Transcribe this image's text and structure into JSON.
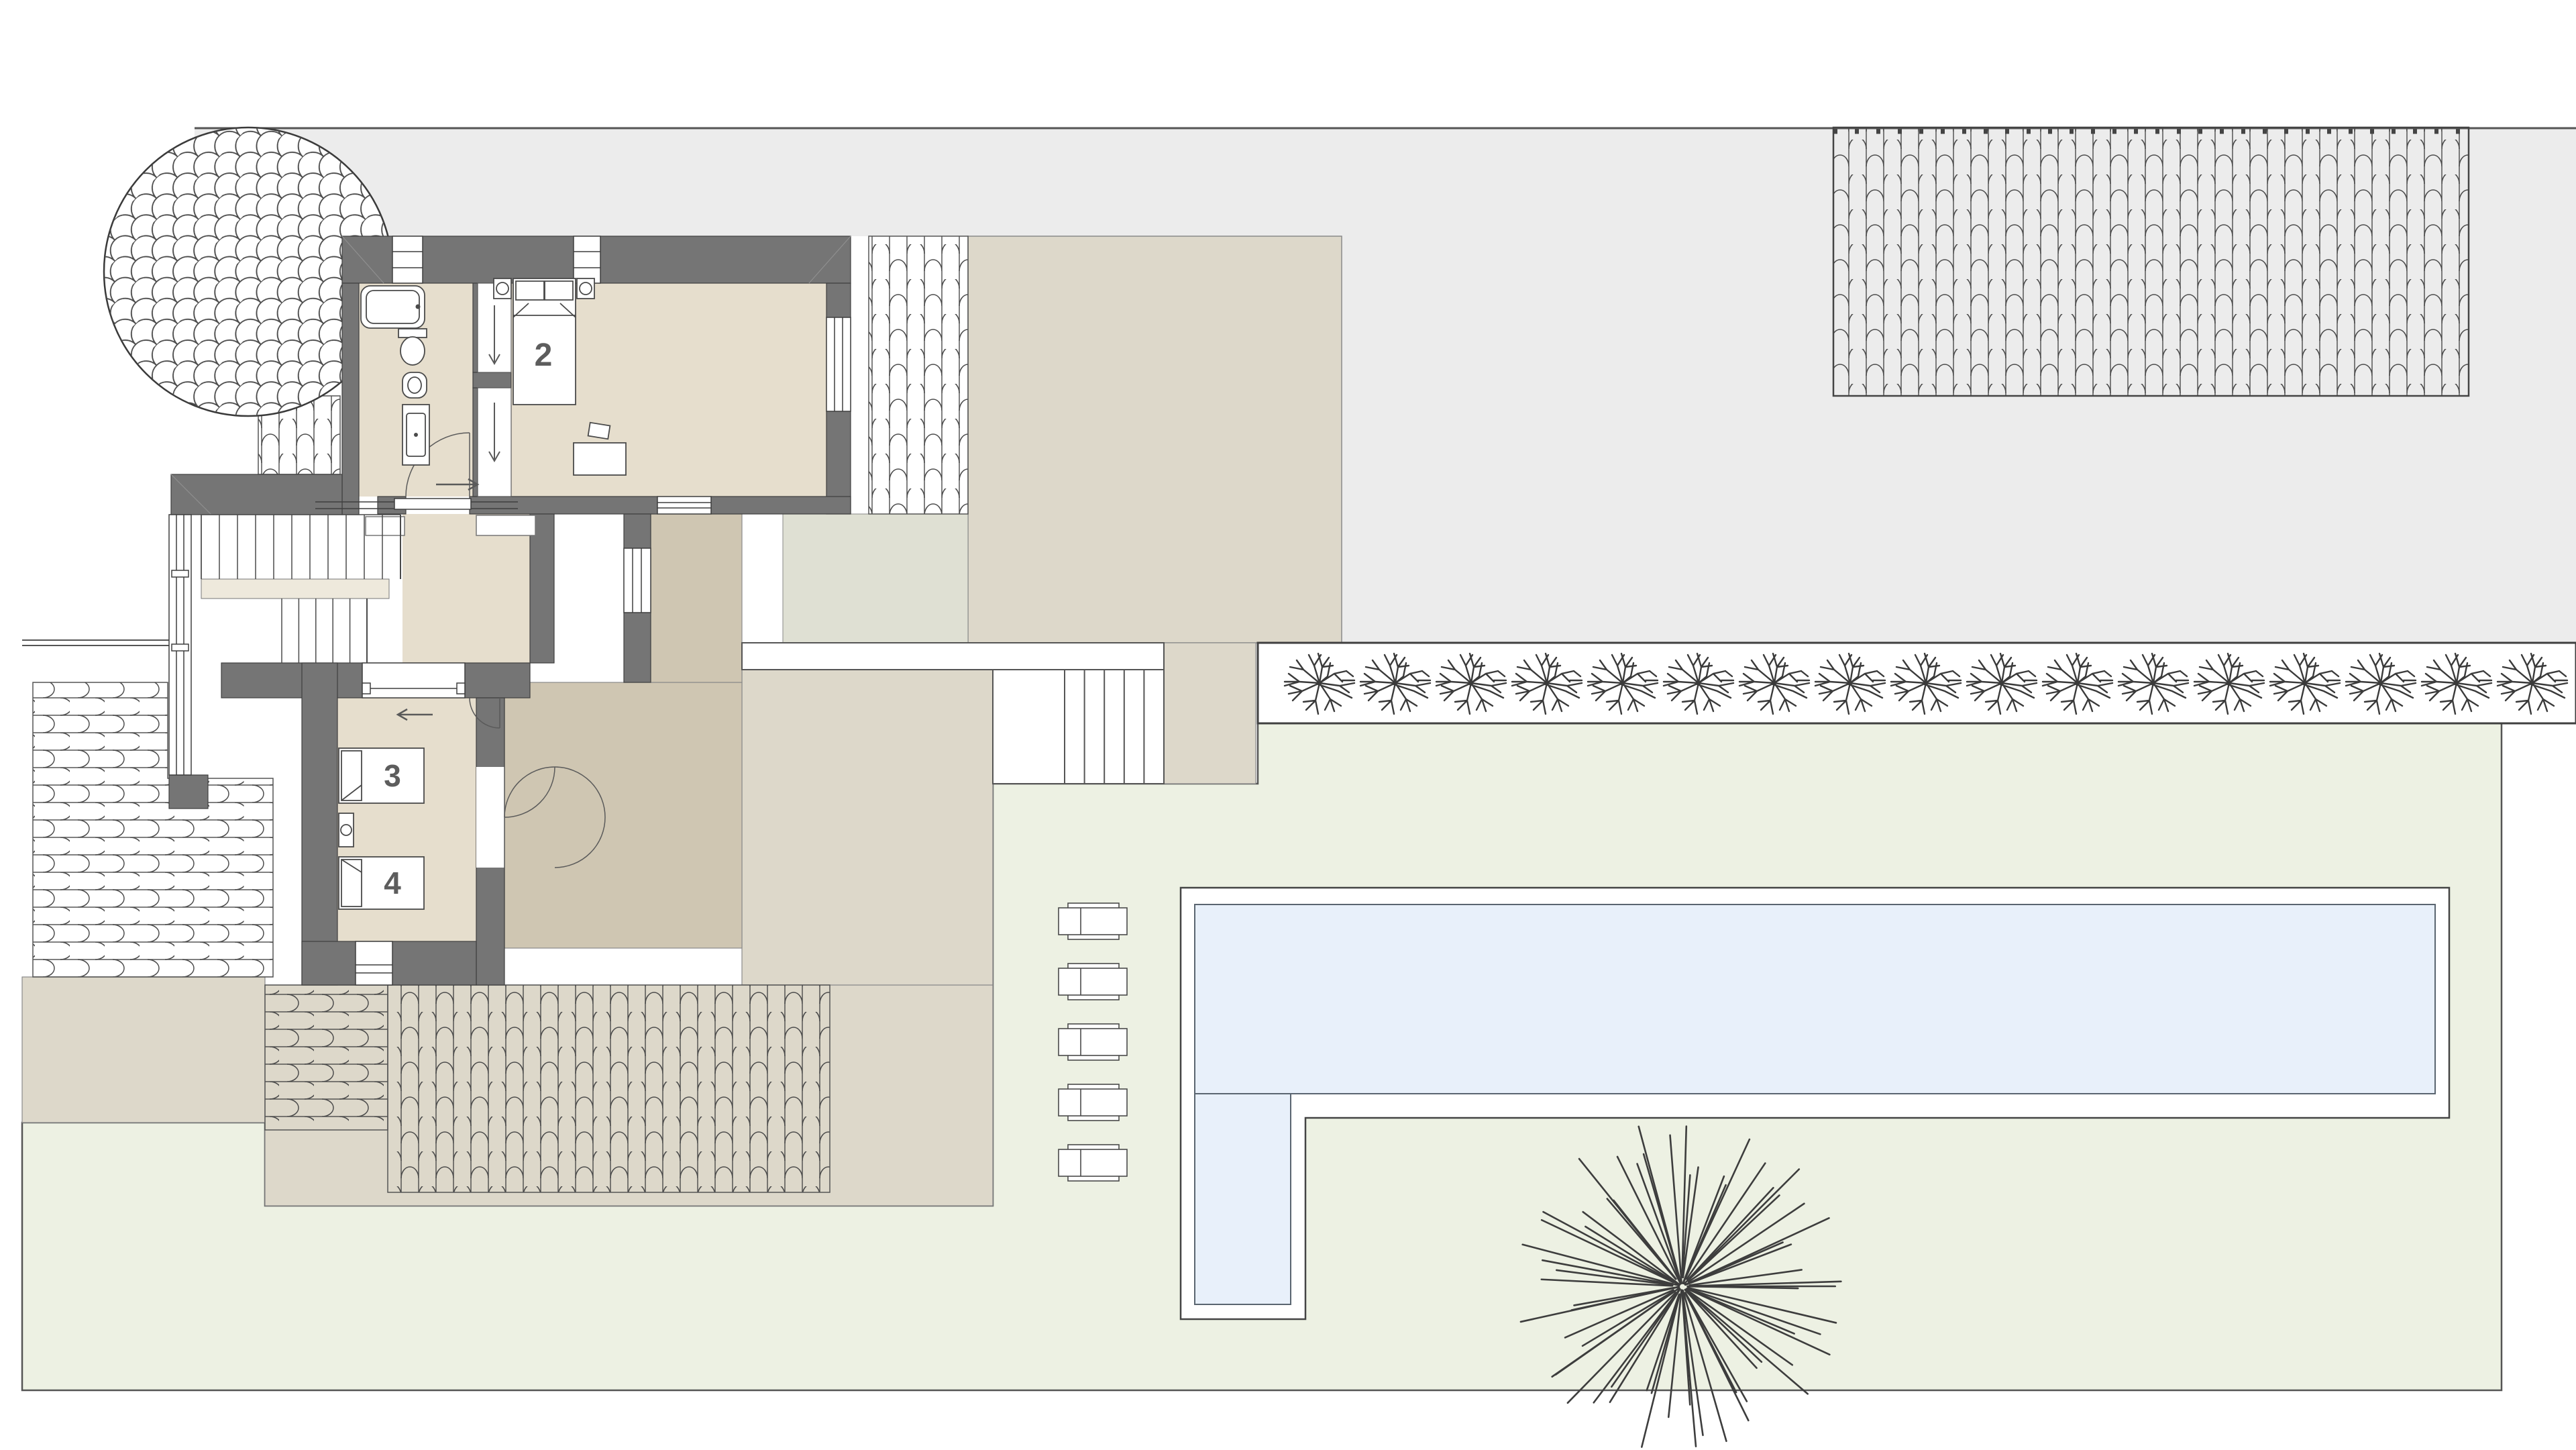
{
  "rooms": [
    {
      "name": "bedroom-2",
      "label": "2"
    },
    {
      "name": "bedroom-3-bed",
      "label": "3"
    },
    {
      "name": "bedroom-4-bed",
      "label": "4"
    }
  ],
  "site": {
    "sun_lounger_count": 5,
    "hedge_shrub_count": 17,
    "palm_ray_count": 64,
    "stair_upper_tread_count": 11,
    "stair_lower_tread_count": 5,
    "outdoor_step_tread_count": 6,
    "pool_section_count": 2
  },
  "colors": {
    "paper": "#ffffff",
    "driveway_gray": "#ececec",
    "wall_gray": "#757575",
    "floor_beige": "#e6decd",
    "landing_cream": "#eee9dc",
    "terrace_tan": "#ddd8ca",
    "patio_tan": "#cfc6b2",
    "greige": "#dfe0d3",
    "lawn_green": "#edf1e3",
    "pool_blue": "#e8f0fa",
    "line_dark": "#3f3f3f",
    "label_gray": "#5d5d5d"
  },
  "icons": {
    "tree_canopy": "tree-canopy-icon",
    "palm": "palm-tree-icon",
    "shrub": "hedge-shrub-icon",
    "bathtub": "bathtub-icon",
    "toilet": "toilet-icon",
    "bidet": "bidet-icon",
    "vanity": "vanity-sink-icon",
    "bed": "bed-icon",
    "lounger": "sun-lounger-icon"
  }
}
